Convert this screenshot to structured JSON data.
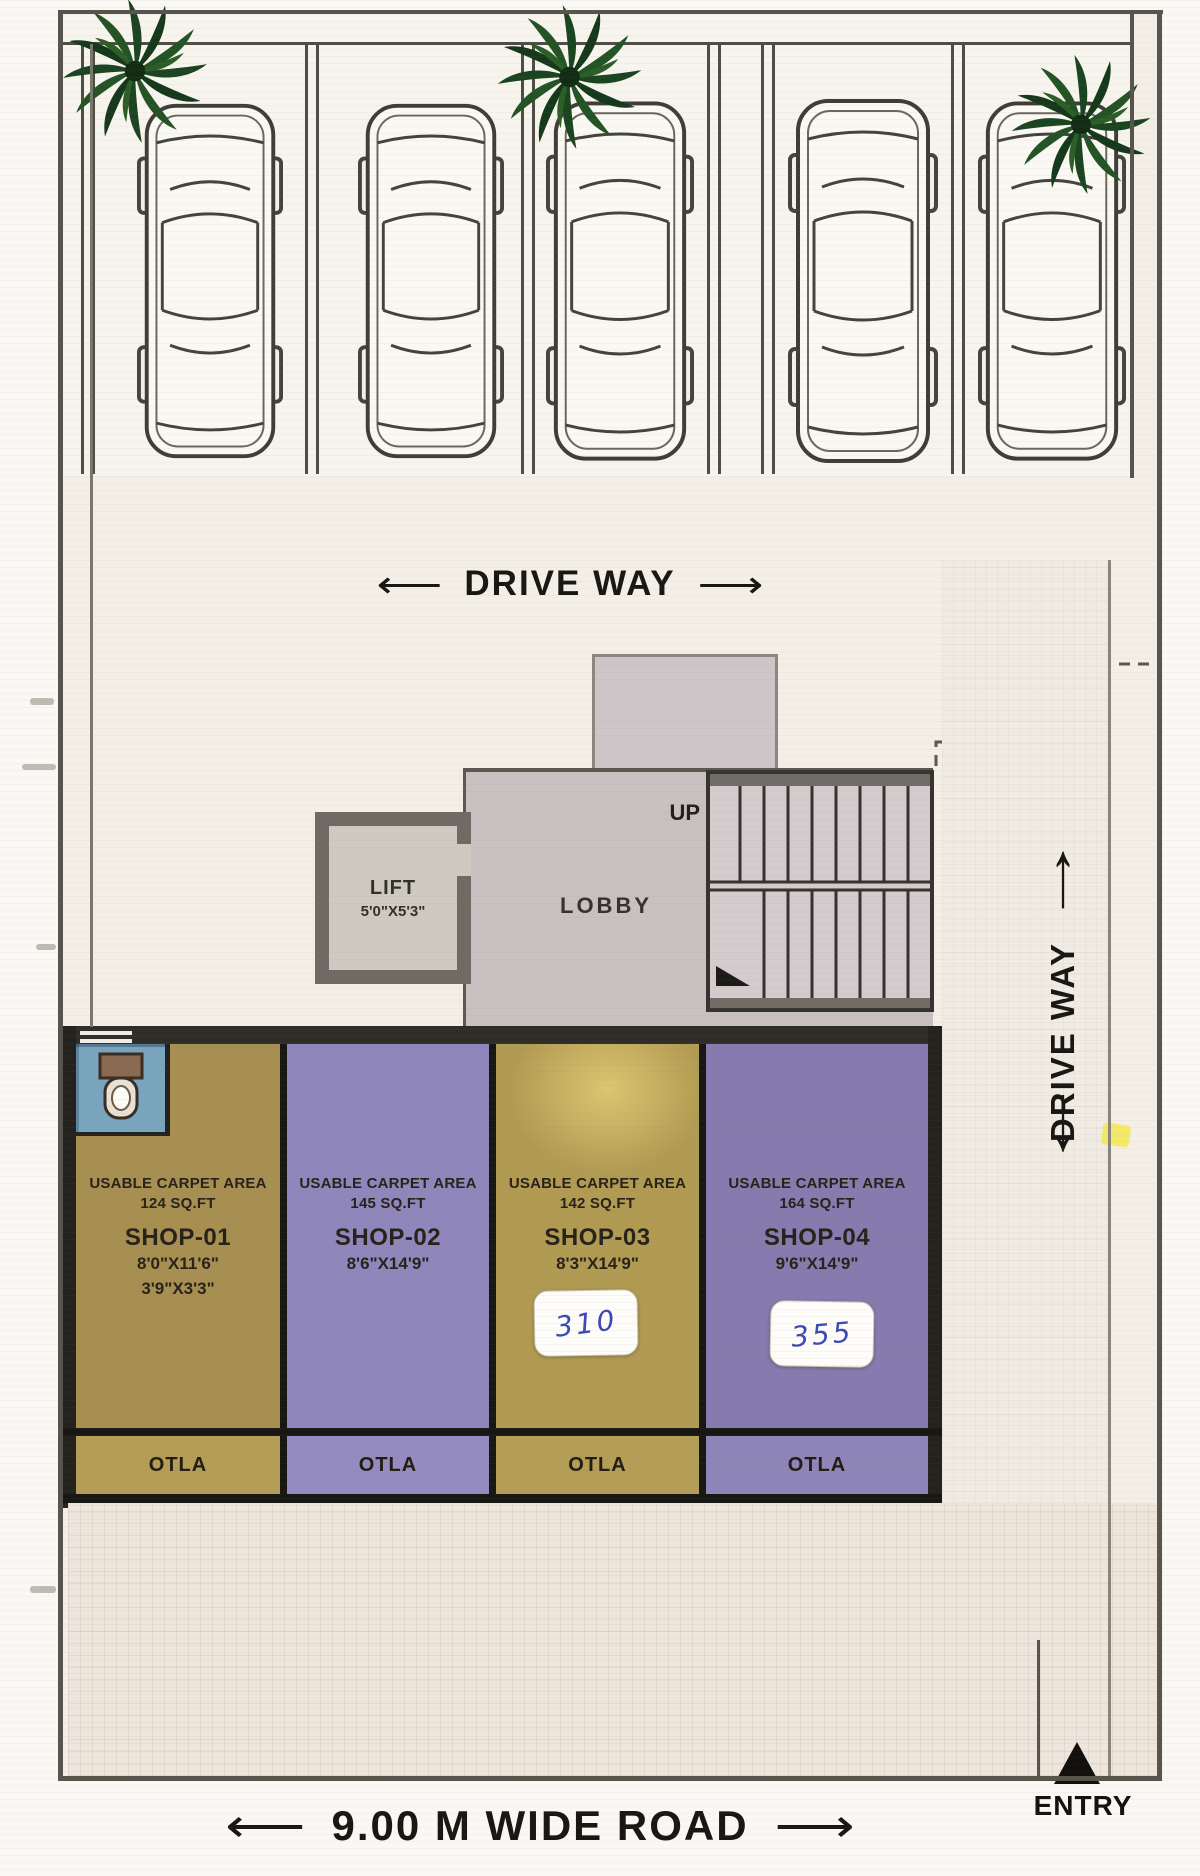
{
  "labels": {
    "driveway_top": "DRIVE WAY",
    "driveway_right": "DRIVE WAY",
    "up": "UP",
    "lobby": "LOBBY",
    "road": "9.00 M WIDE ROAD",
    "entry": "ENTRY"
  },
  "lift": {
    "name": "LIFT",
    "size": "5'0\"X5'3\""
  },
  "shops": [
    {
      "area_label": "USABLE CARPET AREA",
      "area_value": "124 SQ.FT",
      "name": "SHOP-01",
      "dim1": "8'0\"X11'6\"",
      "dim2": "3'9\"X3'3\"",
      "otla_label": "OTLA",
      "note": ""
    },
    {
      "area_label": "USABLE CARPET AREA",
      "area_value": "145 SQ.FT",
      "name": "SHOP-02",
      "dim1": "8'6\"X14'9\"",
      "dim2": "",
      "otla_label": "OTLA",
      "note": ""
    },
    {
      "area_label": "USABLE CARPET AREA",
      "area_value": "142 SQ.FT",
      "name": "SHOP-03",
      "dim1": "8'3\"X14'9\"",
      "dim2": "",
      "otla_label": "OTLA",
      "note": "310"
    },
    {
      "area_label": "USABLE CARPET AREA",
      "area_value": "164 SQ.FT",
      "name": "SHOP-04",
      "dim1": "9'6\"X14'9\"",
      "dim2": "",
      "otla_label": "OTLA",
      "note": "355"
    }
  ],
  "icons": {
    "long_arrow_left": "⟵",
    "long_arrow_right": "⟶",
    "arrow_up": "↑",
    "arrow_down": "↓",
    "entry_arrow": "▲"
  },
  "colors": {
    "paper": "#f3efe7",
    "ink": "#1d1b17",
    "wall_dark": "#24221e",
    "shop1_gold": "#a78f52",
    "shop2_purple": "#8f86bc",
    "shop3_gold": "#b19a52",
    "shop4_purple": "#857bae",
    "otla_gold": "#b49d54",
    "otla_purple": "#948bc0",
    "lobby_gray": "#c9c0c2",
    "lift_wall_gray": "#6f6a64",
    "toilet_blue": "#79a5bf",
    "sticker_white": "#fdfcf8",
    "handwriting_blue": "#3b49b4",
    "palm_green": "#1b4420",
    "highlight_yellow": "#f2e84d"
  }
}
